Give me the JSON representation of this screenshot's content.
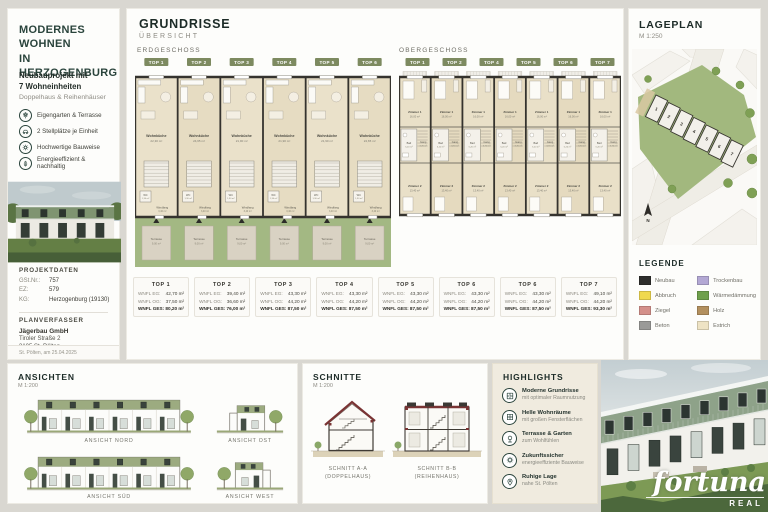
{
  "left_panel": {
    "title_lines": [
      "MODERNES",
      "WOHNEN",
      "IN HERZOGENBURG"
    ],
    "subtitle_bold_lines": [
      "Neubauprojekt mit",
      "7 Wohneinheiten"
    ],
    "subtitle": "Doppelhaus & Reihenhäuser",
    "features": [
      {
        "icon": "garden-icon",
        "label": "Eigengarten & Terrasse"
      },
      {
        "icon": "car-icon",
        "label": "2 Stellplätze je Einheit"
      },
      {
        "icon": "quality-icon",
        "label": "Hochwertige Bauweise"
      },
      {
        "icon": "leaf-icon",
        "label": "Energieeffizient & nachhaltig"
      }
    ],
    "projektdaten": {
      "heading": "PROJEKTDATEN",
      "rows": [
        {
          "label": "GSt.Nr.:",
          "value": "757"
        },
        {
          "label": "EZ:",
          "value": "579"
        },
        {
          "label": "KG:",
          "value": "Herzogenburg (19130)"
        }
      ]
    },
    "planverfasser": {
      "heading": "PLANVERFASSER",
      "name": "Jägerbau GmbH",
      "address_lines": [
        "Tiroler Straße 2",
        "3105 St. Pölten"
      ]
    },
    "footer": "St. Pölten, am 25.04.2025"
  },
  "grundrisse": {
    "title": "GRUNDRISSE",
    "subtitle": "ÜBERSICHT",
    "erdgeschoss": {
      "label": "ERDGESCHOSS",
      "tops": [
        "TOP 1",
        "TOP 2",
        "TOP 3",
        "TOP 4",
        "TOP 5",
        "TOP 6"
      ],
      "wohnkueche_label": "Wohnküche",
      "wohnkueche_areas": [
        "22,30 m²",
        "24,65 m²",
        "21,90 m²",
        "21,90 m²",
        "21,90 m²",
        "24,65 m²"
      ],
      "wc": {
        "name": "WC",
        "area": "1,30 m²"
      },
      "windfang": {
        "name": "Windfang",
        "area": "3,40 m²"
      },
      "terrasse": {
        "name": "Terrasse",
        "area": "9,00 m²"
      }
    },
    "obergeschoss": {
      "label": "OBERGESCHOSS",
      "tops": [
        "TOP 1",
        "TOP 2",
        "TOP 4",
        "TOP 5",
        "TOP 6",
        "TOP 7"
      ],
      "zimmer1": {
        "name": "Zimmer 1",
        "area": "16,00 m²"
      },
      "gang": {
        "name": "Gang",
        "area": "3,70 m²"
      },
      "bad": {
        "name": "Bad",
        "area": "5,20 m²"
      },
      "zimmer2": {
        "name": "Zimmer 2",
        "area": "13,40 m²"
      }
    },
    "row_labels": {
      "eg": "WNFL EG:",
      "og": "WNFL OG:",
      "ges": "WNFL GES:"
    },
    "units": [
      {
        "name": "TOP 1",
        "eg": "42,70 m²",
        "og": "37,50 m²",
        "ges": "80,20 m²"
      },
      {
        "name": "TOP 2",
        "eg": "39,40 m²",
        "og": "36,60 m²",
        "ges": "76,00 m²"
      },
      {
        "name": "TOP 3",
        "eg": "43,30 m²",
        "og": "44,20 m²",
        "ges": "87,50 m²"
      },
      {
        "name": "TOP 4",
        "eg": "43,30 m²",
        "og": "44,20 m²",
        "ges": "87,50 m²"
      },
      {
        "name": "TOP 5",
        "eg": "43,30 m²",
        "og": "44,20 m²",
        "ges": "87,50 m²"
      },
      {
        "name": "TOP 6",
        "eg": "43,30 m²",
        "og": "44,20 m²",
        "ges": "87,50 m²"
      },
      {
        "name": "TOP 6",
        "eg": "43,30 m²",
        "og": "44,20 m²",
        "ges": "87,50 m²"
      },
      {
        "name": "TOP 7",
        "eg": "49,10 m²",
        "og": "44,20 m²",
        "ges": "93,30 m²"
      }
    ]
  },
  "lageplan": {
    "title": "LAGEPLAN",
    "scale": "M 1:250",
    "unit_numbers": [
      "1",
      "2",
      "3",
      "4",
      "5",
      "6",
      "7"
    ],
    "north_label": "N"
  },
  "legende": {
    "heading": "LEGENDE",
    "items": [
      {
        "label": "Neubau",
        "color": "#2e2e2c"
      },
      {
        "label": "Abbruch",
        "color": "#f0d94f"
      },
      {
        "label": "Ziegel",
        "color": "#d4908a"
      },
      {
        "label": "Beton",
        "color": "#9a9a98"
      },
      {
        "label": "Trockenbau",
        "color": "#b3a8d4"
      },
      {
        "label": "Wärmedämmung",
        "color": "#6fa04c"
      },
      {
        "label": "Holz",
        "color": "#b3905e"
      },
      {
        "label": "Estrich",
        "color": "#eee3c4"
      }
    ]
  },
  "ansichten": {
    "title": "ANSICHTEN",
    "scale": "M 1:200",
    "labels": [
      "ANSICHT NORD",
      "ANSICHT OST",
      "ANSICHT SÜD",
      "ANSICHT WEST"
    ]
  },
  "schnitte": {
    "title": "SCHNITTE",
    "scale": "M 1:200",
    "sections": [
      {
        "label": "SCHNITT A-A",
        "sublabel": "(DOPPELHAUS)"
      },
      {
        "label": "SCHNITT B-B",
        "sublabel": "(REIHENHAUS)"
      }
    ]
  },
  "highlights": {
    "title": "HIGHLIGHTS",
    "items": [
      {
        "icon": "floorplan-icon",
        "title": "Moderne Grundrisse",
        "subtitle": "mit optimaler Raumnutzung"
      },
      {
        "icon": "window-icon",
        "title": "Helle Wohnräume",
        "subtitle": "mit großen Fensterflächen"
      },
      {
        "icon": "tree-icon",
        "title": "Terrasse & Garten",
        "subtitle": "zum Wohlfühlen"
      },
      {
        "icon": "future-icon",
        "title": "Zukunftssicher",
        "subtitle": "energieeffiziente Bauweise"
      },
      {
        "icon": "location-icon",
        "title": "Ruhige Lage",
        "subtitle": "nahe St. Pölten"
      }
    ]
  },
  "brand": {
    "name": "fortuna",
    "sub": "REAL"
  }
}
